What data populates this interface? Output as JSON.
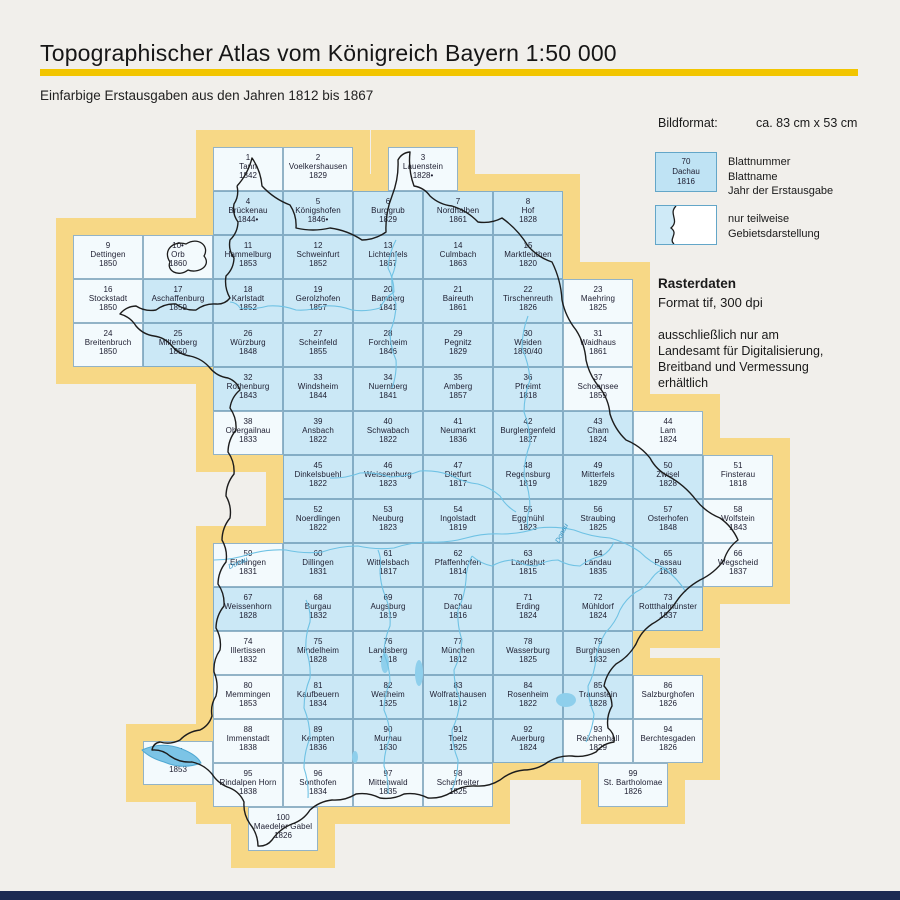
{
  "header": {
    "title": "Topographischer Atlas vom Königreich Bayern 1:50 000",
    "subtitle": "Einfarbige Erstausgaben aus den Jahren 1812 bis 1867"
  },
  "legend": {
    "format_label": "Bildformat:",
    "format_value": "ca. 83 cm x 53 cm",
    "sample_sheet": {
      "number": "70",
      "name": "Dachau",
      "year": "1816"
    },
    "sample_labels": [
      "Blattnummer",
      "Blattname",
      "Jahr der Erstausgabe"
    ],
    "partial_label": "nur teilweise Gebietsdarstellung",
    "raster_title": "Rasterdaten",
    "raster_format": "Format tif, 300 dpi",
    "raster_note": "ausschließlich nur am Landesamt für Digitalisierung, Breitband und Vermessung erhältlich"
  },
  "map": {
    "river_labels": [
      "Donau",
      "Donau"
    ],
    "colors": {
      "frame_yellow": "#f7d886",
      "cell_blue": "#cbe8f6",
      "cell_partial": "#f3fafd",
      "boundary": "#1c1c1c",
      "river": "#6fc2e4",
      "lake": "#8ecfec"
    },
    "sheets": [
      {
        "n": "1",
        "name": "Tann",
        "year": "1842",
        "col": 3,
        "row": 1,
        "partial": true
      },
      {
        "n": "2",
        "name": "Voelkershausen",
        "year": "1829",
        "col": 4,
        "row": 1,
        "partial": true
      },
      {
        "n": "3",
        "name": "Lauenstein",
        "year": "1828•",
        "col": 5.5,
        "row": 1,
        "partial": true
      },
      {
        "n": "4",
        "name": "Brückenau",
        "year": "1844•",
        "col": 3,
        "row": 2
      },
      {
        "n": "5",
        "name": "Königshofen",
        "year": "1846•",
        "col": 4,
        "row": 2
      },
      {
        "n": "6",
        "name": "Burggrub",
        "year": "1829",
        "col": 5,
        "row": 2
      },
      {
        "n": "7",
        "name": "Nordhalben",
        "year": "1861",
        "col": 6,
        "row": 2
      },
      {
        "n": "8",
        "name": "Hof",
        "year": "1828",
        "col": 7,
        "row": 2
      },
      {
        "n": "9",
        "name": "Dettingen",
        "year": "1850",
        "col": 1,
        "row": 3,
        "partial": true
      },
      {
        "n": "10•",
        "name": "Orb",
        "year": "1860",
        "col": 2,
        "row": 3,
        "partial": true
      },
      {
        "n": "11",
        "name": "Hammelburg",
        "year": "1853",
        "col": 3,
        "row": 3
      },
      {
        "n": "12",
        "name": "Schweinfurt",
        "year": "1852",
        "col": 4,
        "row": 3
      },
      {
        "n": "13",
        "name": "Lichtenfels",
        "year": "1867",
        "col": 5,
        "row": 3
      },
      {
        "n": "14",
        "name": "Culmbach",
        "year": "1863",
        "col": 6,
        "row": 3
      },
      {
        "n": "15",
        "name": "Marktleuthen",
        "year": "1820",
        "col": 7,
        "row": 3
      },
      {
        "n": "16",
        "name": "Stockstadt",
        "year": "1850",
        "col": 1,
        "row": 4,
        "partial": true
      },
      {
        "n": "17",
        "name": "Aschaffenburg",
        "year": "1859",
        "col": 2,
        "row": 4
      },
      {
        "n": "18",
        "name": "Karlstadt",
        "year": "1852",
        "col": 3,
        "row": 4
      },
      {
        "n": "19",
        "name": "Gerolzhofen",
        "year": "1857",
        "col": 4,
        "row": 4
      },
      {
        "n": "20",
        "name": "Bamberg",
        "year": "1841",
        "col": 5,
        "row": 4
      },
      {
        "n": "21",
        "name": "Baireuth",
        "year": "1861",
        "col": 6,
        "row": 4
      },
      {
        "n": "22",
        "name": "Tirschenreuth",
        "year": "1826",
        "col": 7,
        "row": 4
      },
      {
        "n": "23",
        "name": "Maehring",
        "year": "1825",
        "col": 8,
        "row": 4,
        "partial": true
      },
      {
        "n": "24",
        "name": "Breitenbruch",
        "year": "1850",
        "col": 1,
        "row": 5,
        "partial": true
      },
      {
        "n": "25",
        "name": "Miltenberg",
        "year": "1850",
        "col": 2,
        "row": 5
      },
      {
        "n": "26",
        "name": "Würzburg",
        "year": "1848",
        "col": 3,
        "row": 5
      },
      {
        "n": "27",
        "name": "Scheinfeld",
        "year": "1855",
        "col": 4,
        "row": 5
      },
      {
        "n": "28",
        "name": "Forchheim",
        "year": "1846",
        "col": 5,
        "row": 5
      },
      {
        "n": "29",
        "name": "Pegnitz",
        "year": "1829",
        "col": 6,
        "row": 5
      },
      {
        "n": "30",
        "name": "Weiden",
        "year": "1830/40",
        "col": 7,
        "row": 5
      },
      {
        "n": "31",
        "name": "Waidhaus",
        "year": "1861",
        "col": 8,
        "row": 5,
        "partial": true
      },
      {
        "n": "32",
        "name": "Rothenburg",
        "year": "1843",
        "col": 3,
        "row": 6
      },
      {
        "n": "33",
        "name": "Windsheim",
        "year": "1844",
        "col": 4,
        "row": 6
      },
      {
        "n": "34",
        "name": "Nuernberg",
        "year": "1841",
        "col": 5,
        "row": 6
      },
      {
        "n": "35",
        "name": "Amberg",
        "year": "1857",
        "col": 6,
        "row": 6
      },
      {
        "n": "36",
        "name": "Pfreimt",
        "year": "1818",
        "col": 7,
        "row": 6
      },
      {
        "n": "37",
        "name": "Schoensee",
        "year": "1859",
        "col": 8,
        "row": 6,
        "partial": true
      },
      {
        "n": "38",
        "name": "Obergailnau",
        "year": "1833",
        "col": 3,
        "row": 7,
        "partial": true
      },
      {
        "n": "39",
        "name": "Ansbach",
        "year": "1822",
        "col": 4,
        "row": 7
      },
      {
        "n": "40",
        "name": "Schwabach",
        "year": "1822",
        "col": 5,
        "row": 7
      },
      {
        "n": "41",
        "name": "Neumarkt",
        "year": "1836",
        "col": 6,
        "row": 7
      },
      {
        "n": "42",
        "name": "Burglengenfeld",
        "year": "1827",
        "col": 7,
        "row": 7
      },
      {
        "n": "43",
        "name": "Cham",
        "year": "1824",
        "col": 8,
        "row": 7
      },
      {
        "n": "44",
        "name": "Lam",
        "year": "1824",
        "col": 9,
        "row": 7,
        "partial": true
      },
      {
        "n": "45",
        "name": "Dinkelsbuehl",
        "year": "1822",
        "col": 4,
        "row": 8
      },
      {
        "n": "46",
        "name": "Weissenburg",
        "year": "1823",
        "col": 5,
        "row": 8
      },
      {
        "n": "47",
        "name": "Dietfurt",
        "year": "1817",
        "col": 6,
        "row": 8
      },
      {
        "n": "48",
        "name": "Regensburg",
        "year": "1819",
        "col": 7,
        "row": 8
      },
      {
        "n": "49",
        "name": "Mitterfels",
        "year": "1829",
        "col": 8,
        "row": 8
      },
      {
        "n": "50",
        "name": "Zwisel",
        "year": "1828",
        "col": 9,
        "row": 8
      },
      {
        "n": "51",
        "name": "Finsterau",
        "year": "1818",
        "col": 10,
        "row": 8,
        "partial": true
      },
      {
        "n": "52",
        "name": "Noerdlingen",
        "year": "1822",
        "col": 4,
        "row": 9
      },
      {
        "n": "53",
        "name": "Neuburg",
        "year": "1823",
        "col": 5,
        "row": 9
      },
      {
        "n": "54",
        "name": "Ingolstadt",
        "year": "1819",
        "col": 6,
        "row": 9
      },
      {
        "n": "55",
        "name": "Eggmühl",
        "year": "1823",
        "col": 7,
        "row": 9
      },
      {
        "n": "56",
        "name": "Straubing",
        "year": "1825",
        "col": 8,
        "row": 9
      },
      {
        "n": "57",
        "name": "Osterhofen",
        "year": "1848",
        "col": 9,
        "row": 9
      },
      {
        "n": "58",
        "name": "Wolfstein",
        "year": "1843",
        "col": 10,
        "row": 9,
        "partial": true
      },
      {
        "n": "59",
        "name": "Elchingen",
        "year": "1831",
        "col": 3,
        "row": 10,
        "partial": true
      },
      {
        "n": "60",
        "name": "Dillingen",
        "year": "1831",
        "col": 4,
        "row": 10
      },
      {
        "n": "61",
        "name": "Wittelsbach",
        "year": "1817",
        "col": 5,
        "row": 10
      },
      {
        "n": "62",
        "name": "Pfaffenhofen",
        "year": "1814",
        "col": 6,
        "row": 10
      },
      {
        "n": "63",
        "name": "Landshut",
        "year": "1815",
        "col": 7,
        "row": 10
      },
      {
        "n": "64",
        "name": "Landau",
        "year": "1835",
        "col": 8,
        "row": 10
      },
      {
        "n": "65",
        "name": "Passau",
        "year": "1838",
        "col": 9,
        "row": 10
      },
      {
        "n": "66",
        "name": "Wegscheid",
        "year": "1837",
        "col": 10,
        "row": 10,
        "partial": true
      },
      {
        "n": "67",
        "name": "Weissenhorn",
        "year": "1828",
        "col": 3,
        "row": 11
      },
      {
        "n": "68",
        "name": "Burgau",
        "year": "1832",
        "col": 4,
        "row": 11
      },
      {
        "n": "69",
        "name": "Augsburg",
        "year": "1819",
        "col": 5,
        "row": 11
      },
      {
        "n": "70",
        "name": "Dachau",
        "year": "1816",
        "col": 6,
        "row": 11
      },
      {
        "n": "71",
        "name": "Erding",
        "year": "1824",
        "col": 7,
        "row": 11
      },
      {
        "n": "72",
        "name": "Mühldorf",
        "year": "1824",
        "col": 8,
        "row": 11
      },
      {
        "n": "73",
        "name": "Rottthalmünster",
        "year": "1837",
        "col": 9,
        "row": 11
      },
      {
        "n": "74",
        "name": "Illertissen",
        "year": "1832",
        "col": 3,
        "row": 12,
        "partial": true
      },
      {
        "n": "75",
        "name": "Mindelheim",
        "year": "1828",
        "col": 4,
        "row": 12
      },
      {
        "n": "76",
        "name": "Landsberg",
        "year": "1818",
        "col": 5,
        "row": 12
      },
      {
        "n": "77",
        "name": "München",
        "year": "1812",
        "col": 6,
        "row": 12
      },
      {
        "n": "78",
        "name": "Wasserburg",
        "year": "1825",
        "col": 7,
        "row": 12
      },
      {
        "n": "79",
        "name": "Burghausen",
        "year": "1832",
        "col": 8,
        "row": 12
      },
      {
        "n": "80",
        "name": "Memmingen",
        "year": "1853",
        "col": 3,
        "row": 13,
        "partial": true
      },
      {
        "n": "81",
        "name": "Kaufbeuern",
        "year": "1834",
        "col": 4,
        "row": 13
      },
      {
        "n": "82",
        "name": "Weilheim",
        "year": "1825",
        "col": 5,
        "row": 13
      },
      {
        "n": "83",
        "name": "Wolfratshausen",
        "year": "1812",
        "col": 6,
        "row": 13
      },
      {
        "n": "84",
        "name": "Rosenheim",
        "year": "1822",
        "col": 7,
        "row": 13
      },
      {
        "n": "85",
        "name": "Traunstein",
        "year": "1828",
        "col": 8,
        "row": 13
      },
      {
        "n": "86",
        "name": "Salzburghofen",
        "year": "1826",
        "col": 9,
        "row": 13,
        "partial": true
      },
      {
        "n": "87",
        "name": "Lindau",
        "year": "1853",
        "col": 2,
        "row": 14.5,
        "partial": true
      },
      {
        "n": "88",
        "name": "Immenstadt",
        "year": "1838",
        "col": 3,
        "row": 14,
        "partial": true
      },
      {
        "n": "89",
        "name": "Kempten",
        "year": "1836",
        "col": 4,
        "row": 14
      },
      {
        "n": "90",
        "name": "Murnau",
        "year": "1830",
        "col": 5,
        "row": 14
      },
      {
        "n": "91",
        "name": "Toelz",
        "year": "1825",
        "col": 6,
        "row": 14
      },
      {
        "n": "92",
        "name": "Auerburg",
        "year": "1824",
        "col": 7,
        "row": 14
      },
      {
        "n": "93",
        "name": "Reichenhall",
        "year": "1829",
        "col": 8,
        "row": 14,
        "partial": true
      },
      {
        "n": "94",
        "name": "Berchtesgaden",
        "year": "1826",
        "col": 9,
        "row": 14,
        "partial": true
      },
      {
        "n": "95",
        "name": "Rindalpen Horn",
        "year": "1838",
        "col": 3,
        "row": 15,
        "partial": true
      },
      {
        "n": "96",
        "name": "Sonthofen",
        "year": "1834",
        "col": 4,
        "row": 15,
        "partial": true
      },
      {
        "n": "97",
        "name": "Mittenwald",
        "year": "1835",
        "col": 5,
        "row": 15,
        "partial": true
      },
      {
        "n": "98",
        "name": "Scharfreiter",
        "year": "1825",
        "col": 6,
        "row": 15,
        "partial": true
      },
      {
        "n": "99",
        "name": "St. Bartholomae",
        "year": "1826",
        "col": 8.5,
        "row": 15,
        "partial": true
      },
      {
        "n": "100",
        "name": "Maedeler Gabel",
        "year": "1826",
        "col": 3.5,
        "row": 16,
        "partial": true
      }
    ]
  }
}
